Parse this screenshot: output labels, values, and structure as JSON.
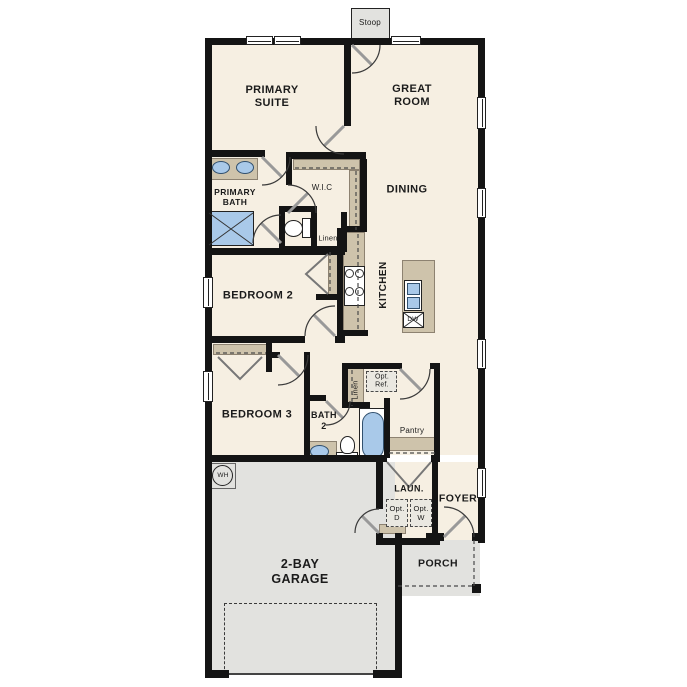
{
  "plan_labels": {
    "stoop": "Stoop",
    "primary_suite": "PRIMARY\nSUITE",
    "great_room": "GREAT\nROOM",
    "primary_bath": "PRIMARY\nBATH",
    "wic": "W.I.C",
    "linen_primary": "Linen",
    "dining": "DINING",
    "kitchen": "KITCHEN",
    "dishwasher": "DW",
    "bedroom2": "BEDROOM 2",
    "bedroom3": "BEDROOM 3",
    "bath2": "BATH\n2",
    "linen_bath2": "Linen",
    "opt_ref": "Opt.\nRef.",
    "pantry": "Pantry",
    "laundry": "LAUN.",
    "foyer": "FOYER",
    "opt_d": "Opt.\nD",
    "opt_w": "Opt.\nW",
    "porch": "PORCH",
    "garage": "2-BAY\nGARAGE",
    "water_heater": "WH"
  },
  "colors": {
    "floor": "#f6efe2",
    "concrete": "#e2e2df",
    "wall": "#141414",
    "cabinet_tan": "#cec3ab",
    "fixture_blue": "#a9c9e9"
  }
}
